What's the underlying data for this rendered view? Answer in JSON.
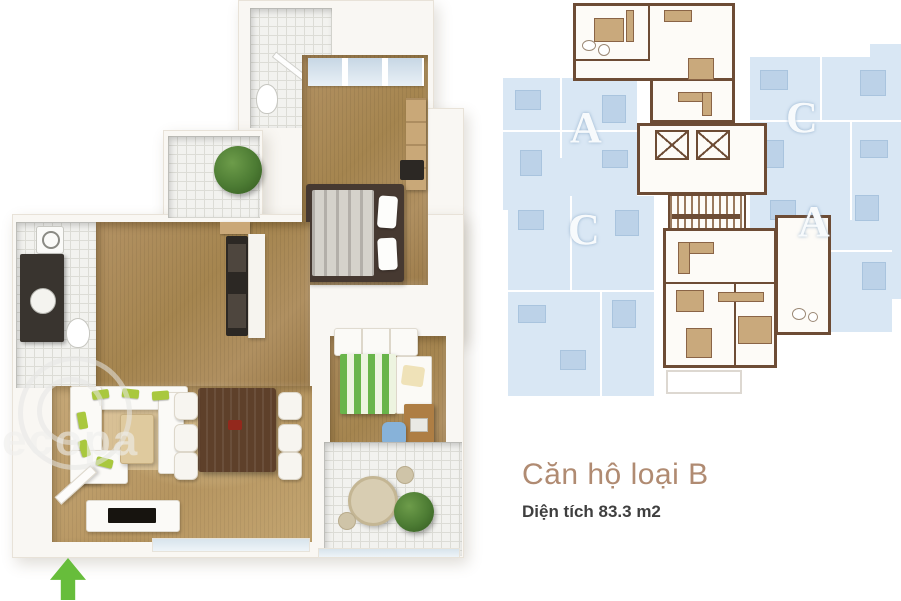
{
  "caption": {
    "title": "Căn hộ loại B",
    "subtitle": "Diện tích 83.3 m2"
  },
  "key_plan": {
    "highlighted_unit": "B",
    "units": [
      {
        "id": "unit-a-upper-left",
        "label": "A"
      },
      {
        "id": "unit-c-upper-right",
        "label": "C"
      },
      {
        "id": "unit-c-lower-left",
        "label": "C"
      },
      {
        "id": "unit-a-lower-right",
        "label": "A"
      }
    ],
    "colors": {
      "unit_fill": "#d9e7f4",
      "unit_furniture": "#bcd2e8",
      "unit_label": "#f7fafc",
      "highlight_wall": "#6d4c35",
      "highlight_furniture": "#c9a97c"
    }
  },
  "floor_plan": {
    "watermark_text": "ecopa",
    "entrance_arrow_color": "#67bd3b",
    "colors": {
      "wood_floor": "#ab8a5a",
      "living_floor": "#c0a474",
      "tile_floor": "#f2f2ef",
      "wall": "#f9f7f3",
      "sofa_pillow_green": "#a9c83e",
      "bed_stripe_green": "#69b54b"
    }
  }
}
